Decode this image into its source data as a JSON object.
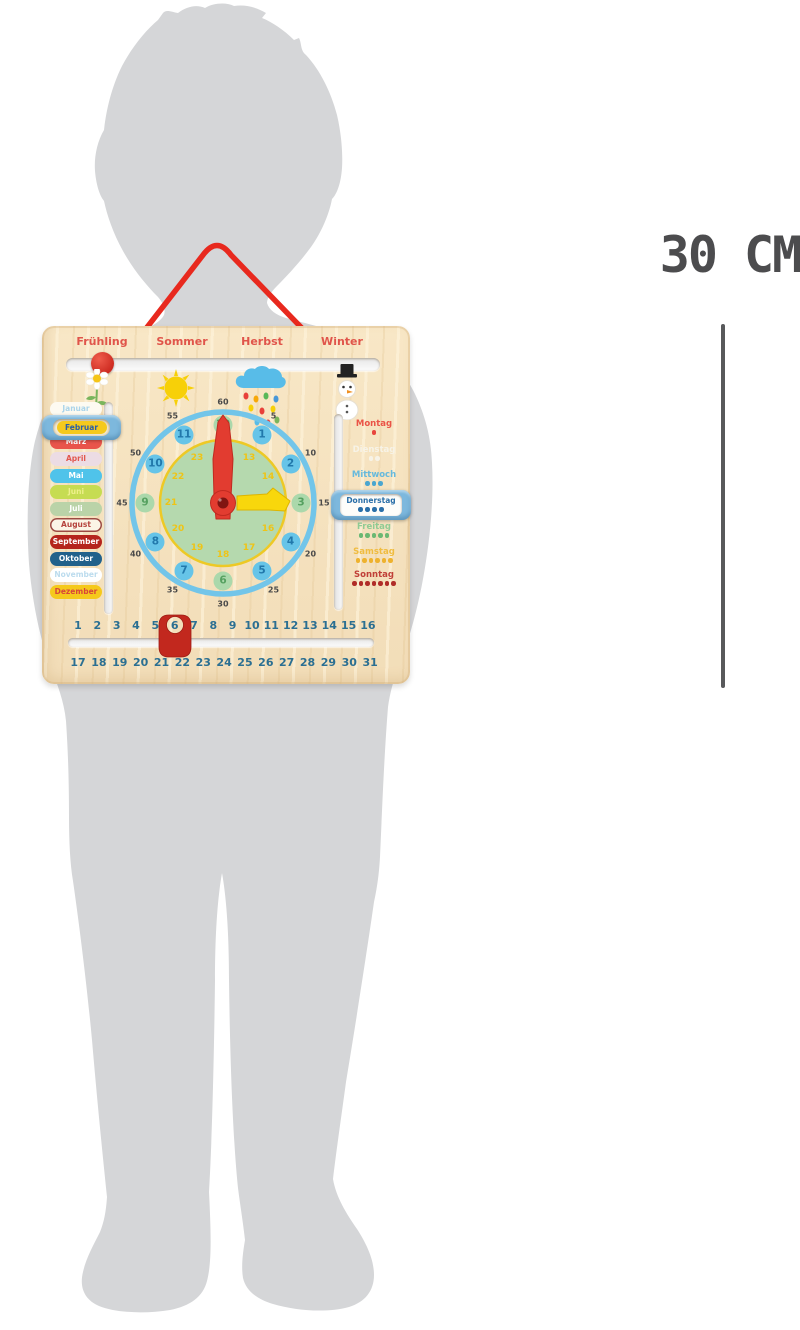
{
  "size_label": "30 CM",
  "seasons": [
    "Frühling",
    "Sommer",
    "Herbst",
    "Winter"
  ],
  "season_icons": [
    "flower-icon",
    "sun-icon",
    "rain-cloud-icon",
    "snowman-icon"
  ],
  "months": [
    {
      "label": "Januar",
      "bg": "#fdfaf1",
      "fg": "#aad4ea"
    },
    {
      "label": "Februar",
      "bg": "#f5c91c",
      "fg": "#2a5da8"
    },
    {
      "label": "März",
      "bg": "#e9544b",
      "fg": "#ffffff"
    },
    {
      "label": "April",
      "bg": "#ecdce4",
      "fg": "#e2574e"
    },
    {
      "label": "Mai",
      "bg": "#4fc3ea",
      "fg": "#ffffff"
    },
    {
      "label": "Juni",
      "bg": "#c6dc52",
      "fg": "#eef08c"
    },
    {
      "label": "Juli",
      "bg": "#bad3a8",
      "fg": "#ffffff"
    },
    {
      "label": "August",
      "bg": "#fbf5e6",
      "fg": "#b5433c",
      "border": "#9c4a42"
    },
    {
      "label": "September",
      "bg": "#b5241c",
      "fg": "#ffffff"
    },
    {
      "label": "Oktober",
      "bg": "#21618b",
      "fg": "#ffffff"
    },
    {
      "label": "November",
      "bg": "#ffffff",
      "fg": "#bcdcee"
    },
    {
      "label": "Dezember",
      "bg": "#f5c91c",
      "fg": "#d8453a"
    }
  ],
  "month_selector": {
    "selected": "Februar"
  },
  "clock": {
    "minute_labels": [
      "5",
      "10",
      "15",
      "20",
      "25",
      "30",
      "35",
      "40",
      "45",
      "50",
      "55",
      "60"
    ],
    "hour_labels": [
      "1",
      "2",
      "3",
      "4",
      "5",
      "6",
      "7",
      "8",
      "9",
      "10",
      "11",
      "12"
    ],
    "hour24_labels": [
      "13",
      "14",
      "15",
      "16",
      "17",
      "18",
      "19",
      "20",
      "21",
      "22",
      "23",
      "24"
    ],
    "green_hours": [
      "3",
      "6",
      "9",
      "12"
    ],
    "hands": {
      "red_hour_hand_points_to": "12",
      "yellow_minute_hand_points_to": "3"
    }
  },
  "days": [
    {
      "label": "Montag",
      "dots": 1,
      "color": "#ea5447",
      "dot_color": "#e8453c"
    },
    {
      "label": "Dienstag",
      "dots": 2,
      "color": "#f7f3e7",
      "dot_color": "#f7f3e7"
    },
    {
      "label": "Mittwoch",
      "dots": 3,
      "color": "#66b9dc",
      "dot_color": "#4aa6d0"
    },
    {
      "label": "Donnerstag",
      "dots": 4,
      "color": "#2a6fa8",
      "dot_color": "#2a6fa8"
    },
    {
      "label": "Freitag",
      "dots": 5,
      "color": "#90cb94",
      "dot_color": "#6bb873"
    },
    {
      "label": "Samstag",
      "dots": 6,
      "color": "#f0bc40",
      "dot_color": "#eeb22e"
    },
    {
      "label": "Sonntag",
      "dots": 7,
      "color": "#c04038",
      "dot_color": "#b02c28"
    }
  ],
  "day_selector": {
    "selected": "Donnerstag"
  },
  "dates": {
    "row1": [
      "1",
      "2",
      "3",
      "4",
      "5",
      "6",
      "7",
      "8",
      "9",
      "10",
      "11",
      "12",
      "13",
      "14",
      "15",
      "16"
    ],
    "row2": [
      "17",
      "18",
      "19",
      "20",
      "21",
      "22",
      "23",
      "24",
      "25",
      "26",
      "27",
      "28",
      "29",
      "30",
      "31"
    ],
    "selected": "6"
  },
  "colors": {
    "silhouette": "#d5d6d8",
    "wood": "#f6e3c1",
    "cord_red": "#e8291e",
    "accent_blue_handle": "#7db8dd",
    "clock_ring_blue": "#72c5e9",
    "clock_face_green": "#b5d9ae",
    "date_number_teal": "#2b6f92",
    "measure_gray": "#58595b"
  }
}
